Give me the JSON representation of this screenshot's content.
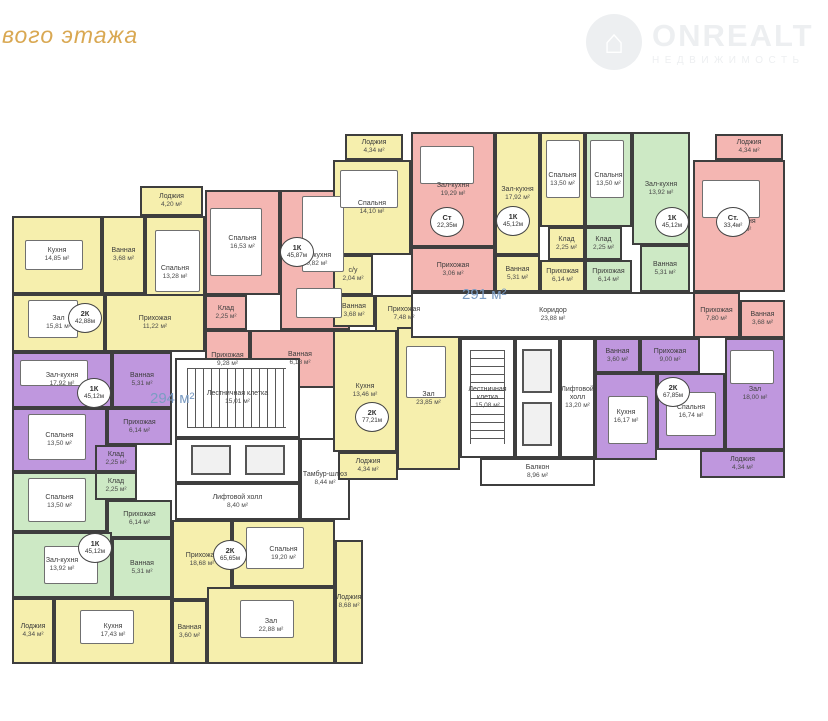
{
  "title": "вого этажа",
  "logo": {
    "brand": "ONREALT",
    "sub": "НЕДВИЖИМОСТЬ",
    "icon_glyph": "⌂"
  },
  "colors": {
    "yellow": "#f6efad",
    "pink": "#f4b6b2",
    "green": "#cde9c5",
    "purple": "#bf97de",
    "white": "#ffffff",
    "wall": "#3e3e3e",
    "blue": "#7b9cc3",
    "gold": "#d9a852"
  },
  "area_labels": [
    {
      "text": "294 м²",
      "x": 150,
      "y": 390
    },
    {
      "text": "291 м²",
      "x": 462,
      "y": 286
    }
  ],
  "rooms": [
    {
      "n": "Лоджия",
      "a": "4,20 м²",
      "x": 140,
      "y": 186,
      "w": 63,
      "h": 30,
      "c": "yellow"
    },
    {
      "n": "Кухня",
      "a": "14,85 м²",
      "x": 12,
      "y": 216,
      "w": 90,
      "h": 78,
      "c": "yellow"
    },
    {
      "n": "Ванная",
      "a": "3,68 м²",
      "x": 102,
      "y": 216,
      "w": 43,
      "h": 78,
      "c": "yellow"
    },
    {
      "n": "Спальня",
      "a": "13,28 м²",
      "x": 145,
      "y": 216,
      "w": 60,
      "h": 114,
      "c": "yellow"
    },
    {
      "n": "Зал",
      "a": "15,81 м²",
      "x": 12,
      "y": 294,
      "w": 93,
      "h": 58,
      "c": "yellow"
    },
    {
      "n": "Прихожая",
      "a": "11,22 м²",
      "x": 105,
      "y": 294,
      "w": 100,
      "h": 58,
      "c": "yellow"
    },
    {
      "n": "Спальня",
      "a": "16,53 м²",
      "x": 205,
      "y": 190,
      "w": 75,
      "h": 105,
      "c": "pink"
    },
    {
      "n": "Зал-кухня",
      "a": "20,82 м²",
      "x": 280,
      "y": 190,
      "w": 70,
      "h": 140,
      "c": "pink"
    },
    {
      "n": "Клад",
      "a": "2,25 м²",
      "x": 205,
      "y": 295,
      "w": 42,
      "h": 35,
      "c": "pink"
    },
    {
      "n": "Прихожая",
      "a": "9,28 м²",
      "x": 205,
      "y": 330,
      "w": 45,
      "h": 60,
      "c": "pink"
    },
    {
      "n": "Ванная",
      "a": "6,18 м²",
      "x": 250,
      "y": 330,
      "w": 100,
      "h": 58,
      "c": "pink"
    },
    {
      "n": "Зал-кухня",
      "a": "17,92 м²",
      "x": 12,
      "y": 352,
      "w": 100,
      "h": 56,
      "c": "purple"
    },
    {
      "n": "Ванная",
      "a": "5,31 м²",
      "x": 112,
      "y": 352,
      "w": 60,
      "h": 56,
      "c": "purple"
    },
    {
      "n": "Спальня",
      "a": "13,50 м²",
      "x": 12,
      "y": 408,
      "w": 95,
      "h": 64,
      "c": "purple"
    },
    {
      "n": "Прихожая",
      "a": "6,14 м²",
      "x": 107,
      "y": 408,
      "w": 65,
      "h": 37,
      "c": "purple"
    },
    {
      "n": "Клад",
      "a": "2,25 м²",
      "x": 95,
      "y": 445,
      "w": 42,
      "h": 27,
      "c": "purple"
    },
    {
      "n": "Спальня",
      "a": "13,50 м²",
      "x": 12,
      "y": 472,
      "w": 95,
      "h": 60,
      "c": "green"
    },
    {
      "n": "Клад",
      "a": "2,25 м²",
      "x": 95,
      "y": 472,
      "w": 42,
      "h": 28,
      "c": "green"
    },
    {
      "n": "Прихожая",
      "a": "6,14 м²",
      "x": 107,
      "y": 500,
      "w": 65,
      "h": 38,
      "c": "green"
    },
    {
      "n": "Зал-кухня",
      "a": "13,92 м²",
      "x": 12,
      "y": 532,
      "w": 100,
      "h": 66,
      "c": "green"
    },
    {
      "n": "Ванная",
      "a": "5,31 м²",
      "x": 112,
      "y": 538,
      "w": 60,
      "h": 60,
      "c": "green"
    },
    {
      "n": "Лоджия",
      "a": "4,34 м²",
      "x": 12,
      "y": 598,
      "w": 42,
      "h": 66,
      "c": "yellow"
    },
    {
      "n": "Кухня",
      "a": "17,43 м²",
      "x": 54,
      "y": 598,
      "w": 118,
      "h": 66,
      "c": "yellow"
    },
    {
      "n": "Прихожая",
      "a": "18,68 м²",
      "x": 172,
      "y": 520,
      "w": 60,
      "h": 80,
      "c": "yellow"
    },
    {
      "n": "Спальня",
      "a": "19,20 м²",
      "x": 232,
      "y": 520,
      "w": 103,
      "h": 67,
      "c": "yellow"
    },
    {
      "n": "Ванная",
      "a": "3,60 м²",
      "x": 172,
      "y": 600,
      "w": 35,
      "h": 64,
      "c": "yellow"
    },
    {
      "n": "Зал",
      "a": "22,88 м²",
      "x": 207,
      "y": 587,
      "w": 128,
      "h": 77,
      "c": "yellow"
    },
    {
      "n": "Лоджия",
      "a": "8,68 м²",
      "x": 335,
      "y": 540,
      "w": 28,
      "h": 124,
      "c": "yellow"
    },
    {
      "n": "Лестничная клетка",
      "a": "15,01 м²",
      "x": 175,
      "y": 358,
      "w": 125,
      "h": 80,
      "c": "white",
      "f": "stairs-h"
    },
    {
      "n": "",
      "a": "",
      "x": 175,
      "y": 438,
      "w": 125,
      "h": 45,
      "c": "white",
      "f": "lifts-h"
    },
    {
      "n": "Лифтовой холл",
      "a": "8,40 м²",
      "x": 175,
      "y": 483,
      "w": 125,
      "h": 37,
      "c": "white"
    },
    {
      "n": "Тамбур-шлюз",
      "a": "8,44 м²",
      "x": 300,
      "y": 438,
      "w": 50,
      "h": 82,
      "c": "white"
    },
    {
      "n": "Лоджия",
      "a": "4,34 м²",
      "x": 345,
      "y": 134,
      "w": 58,
      "h": 26,
      "c": "yellow"
    },
    {
      "n": "Спальня",
      "a": "14,10 м²",
      "x": 333,
      "y": 160,
      "w": 78,
      "h": 95,
      "c": "yellow"
    },
    {
      "n": "с/у",
      "a": "2,04 м²",
      "x": 333,
      "y": 255,
      "w": 40,
      "h": 40,
      "c": "yellow"
    },
    {
      "n": "Ванная",
      "a": "3,68 м²",
      "x": 333,
      "y": 295,
      "w": 42,
      "h": 32,
      "c": "yellow"
    },
    {
      "n": "Прихожая",
      "a": "7,48 м²",
      "x": 375,
      "y": 295,
      "w": 58,
      "h": 37,
      "c": "yellow"
    },
    {
      "n": "Кухня",
      "a": "13,46 м²",
      "x": 333,
      "y": 330,
      "w": 64,
      "h": 122,
      "c": "yellow"
    },
    {
      "n": "Зал",
      "a": "23,85 м²",
      "x": 397,
      "y": 327,
      "w": 63,
      "h": 143,
      "c": "yellow"
    },
    {
      "n": "Лоджия",
      "a": "4,34 м²",
      "x": 338,
      "y": 452,
      "w": 60,
      "h": 28,
      "c": "yellow"
    },
    {
      "n": "Коридор",
      "a": "23,88 м²",
      "x": 411,
      "y": 292,
      "w": 284,
      "h": 46,
      "c": "white"
    },
    {
      "n": "Зал-кухня",
      "a": "19,29 м²",
      "x": 411,
      "y": 132,
      "w": 84,
      "h": 115,
      "c": "pink"
    },
    {
      "n": "Прихожая",
      "a": "3,06 м²",
      "x": 411,
      "y": 247,
      "w": 84,
      "h": 45,
      "c": "pink"
    },
    {
      "n": "Зал-кухня",
      "a": "17,92 м²",
      "x": 495,
      "y": 132,
      "w": 45,
      "h": 123,
      "c": "yellow"
    },
    {
      "n": "Спальня",
      "a": "13,50 м²",
      "x": 540,
      "y": 132,
      "w": 45,
      "h": 95,
      "c": "yellow"
    },
    {
      "n": "Клад",
      "a": "2,25 м²",
      "x": 548,
      "y": 227,
      "w": 37,
      "h": 33,
      "c": "yellow"
    },
    {
      "n": "Ванная",
      "a": "5,31 м²",
      "x": 495,
      "y": 255,
      "w": 45,
      "h": 37,
      "c": "yellow"
    },
    {
      "n": "Прихожая",
      "a": "6,14 м²",
      "x": 540,
      "y": 260,
      "w": 45,
      "h": 32,
      "c": "yellow"
    },
    {
      "n": "Спальня",
      "a": "13,50 м²",
      "x": 585,
      "y": 132,
      "w": 47,
      "h": 95,
      "c": "green"
    },
    {
      "n": "Клад",
      "a": "2,25 м²",
      "x": 585,
      "y": 227,
      "w": 37,
      "h": 33,
      "c": "green"
    },
    {
      "n": "Прихожая",
      "a": "6,14 м²",
      "x": 585,
      "y": 260,
      "w": 47,
      "h": 32,
      "c": "green"
    },
    {
      "n": "Зал-кухня",
      "a": "13,92 м²",
      "x": 632,
      "y": 132,
      "w": 58,
      "h": 113,
      "c": "green"
    },
    {
      "n": "Ванная",
      "a": "5,31 м²",
      "x": 640,
      "y": 245,
      "w": 50,
      "h": 47,
      "c": "green"
    },
    {
      "n": "Лоджия",
      "a": "4,34 м²",
      "x": 715,
      "y": 134,
      "w": 68,
      "h": 26,
      "c": "pink"
    },
    {
      "n": "Зал-Кухня",
      "a": "17,65 м²",
      "x": 693,
      "y": 160,
      "w": 92,
      "h": 132,
      "c": "pink"
    },
    {
      "n": "Прихожая",
      "a": "7,80 м²",
      "x": 693,
      "y": 292,
      "w": 47,
      "h": 46,
      "c": "pink"
    },
    {
      "n": "Ванная",
      "a": "3,68 м²",
      "x": 740,
      "y": 300,
      "w": 45,
      "h": 38,
      "c": "pink"
    },
    {
      "n": "Лестничная клетка",
      "a": "15,08 м²",
      "x": 460,
      "y": 338,
      "w": 55,
      "h": 120,
      "c": "white",
      "f": "stairs-v"
    },
    {
      "n": "",
      "a": "",
      "x": 515,
      "y": 338,
      "w": 45,
      "h": 120,
      "c": "white",
      "f": "lifts-v"
    },
    {
      "n": "Лифтовой холл",
      "a": "13,20 м²",
      "x": 560,
      "y": 338,
      "w": 35,
      "h": 120,
      "c": "white"
    },
    {
      "n": "Балкон",
      "a": "8,96 м²",
      "x": 480,
      "y": 458,
      "w": 115,
      "h": 28,
      "c": "white"
    },
    {
      "n": "Ванная",
      "a": "3,60 м²",
      "x": 595,
      "y": 338,
      "w": 45,
      "h": 35,
      "c": "purple"
    },
    {
      "n": "Прихожая",
      "a": "9,00 м²",
      "x": 640,
      "y": 338,
      "w": 60,
      "h": 35,
      "c": "purple"
    },
    {
      "n": "Кухня",
      "a": "16,17 м²",
      "x": 595,
      "y": 373,
      "w": 62,
      "h": 87,
      "c": "purple"
    },
    {
      "n": "Спальня",
      "a": "16,74 м²",
      "x": 657,
      "y": 373,
      "w": 68,
      "h": 77,
      "c": "purple"
    },
    {
      "n": "Зал",
      "a": "18,00 м²",
      "x": 725,
      "y": 338,
      "w": 60,
      "h": 112,
      "c": "purple"
    },
    {
      "n": "Лоджия",
      "a": "4,34 м²",
      "x": 700,
      "y": 450,
      "w": 85,
      "h": 28,
      "c": "purple"
    }
  ],
  "badges": [
    {
      "t": "2К",
      "a": "42,88м",
      "x": 85,
      "y": 318
    },
    {
      "t": "1К",
      "a": "45,87м",
      "x": 297,
      "y": 252
    },
    {
      "t": "1К",
      "a": "45,12м",
      "x": 94,
      "y": 393
    },
    {
      "t": "1К",
      "a": "45,12м",
      "x": 95,
      "y": 548
    },
    {
      "t": "2К",
      "a": "65,65м",
      "x": 230,
      "y": 555
    },
    {
      "t": "2К",
      "a": "77,21м",
      "x": 372,
      "y": 417
    },
    {
      "t": "Ст",
      "a": "22,35м",
      "x": 447,
      "y": 222
    },
    {
      "t": "1К",
      "a": "45,12м",
      "x": 513,
      "y": 221
    },
    {
      "t": "1К",
      "a": "45,12м",
      "x": 672,
      "y": 222
    },
    {
      "t": "Ст.",
      "a": "33,4м²",
      "x": 733,
      "y": 222
    },
    {
      "t": "2К",
      "a": "67,85м",
      "x": 673,
      "y": 392
    }
  ],
  "furniture": [
    {
      "x": 155,
      "y": 230,
      "w": 45,
      "h": 62
    },
    {
      "x": 25,
      "y": 240,
      "w": 58,
      "h": 30
    },
    {
      "x": 28,
      "y": 300,
      "w": 50,
      "h": 38
    },
    {
      "x": 210,
      "y": 208,
      "w": 52,
      "h": 68
    },
    {
      "x": 302,
      "y": 196,
      "w": 42,
      "h": 76
    },
    {
      "x": 296,
      "y": 288,
      "w": 46,
      "h": 30
    },
    {
      "x": 20,
      "y": 360,
      "w": 68,
      "h": 26
    },
    {
      "x": 28,
      "y": 414,
      "w": 58,
      "h": 46
    },
    {
      "x": 28,
      "y": 478,
      "w": 58,
      "h": 44
    },
    {
      "x": 44,
      "y": 546,
      "w": 54,
      "h": 38
    },
    {
      "x": 80,
      "y": 610,
      "w": 54,
      "h": 34
    },
    {
      "x": 246,
      "y": 527,
      "w": 58,
      "h": 42
    },
    {
      "x": 240,
      "y": 600,
      "w": 54,
      "h": 38
    },
    {
      "x": 340,
      "y": 170,
      "w": 58,
      "h": 38
    },
    {
      "x": 406,
      "y": 346,
      "w": 40,
      "h": 52
    },
    {
      "x": 420,
      "y": 146,
      "w": 54,
      "h": 38
    },
    {
      "x": 546,
      "y": 140,
      "w": 34,
      "h": 58
    },
    {
      "x": 590,
      "y": 140,
      "w": 34,
      "h": 58
    },
    {
      "x": 702,
      "y": 180,
      "w": 58,
      "h": 38
    },
    {
      "x": 608,
      "y": 396,
      "w": 40,
      "h": 48
    },
    {
      "x": 666,
      "y": 392,
      "w": 50,
      "h": 44
    },
    {
      "x": 730,
      "y": 350,
      "w": 44,
      "h": 34
    }
  ]
}
